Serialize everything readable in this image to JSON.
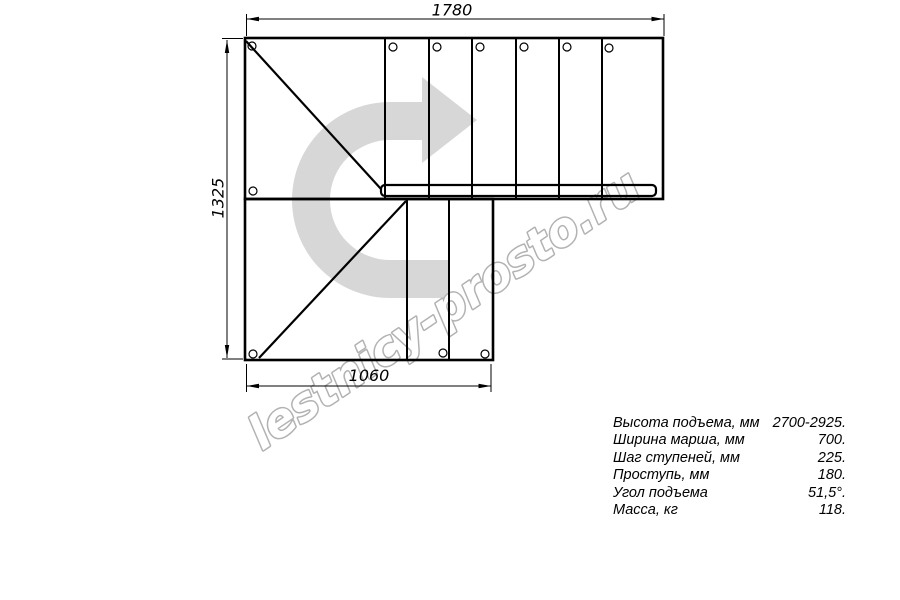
{
  "drawing": {
    "title": "stair-plan-top-view",
    "watermark": "lestnicy-prosto.ru",
    "dimensions": {
      "top": "1780",
      "left": "1325",
      "bottom": "1060"
    },
    "colors": {
      "line": "#000000",
      "arrow_fill": "#d7d7d7",
      "watermark_stroke": "#b2b2b2"
    }
  },
  "specs": {
    "rows": [
      {
        "label": "Высота подъема, мм",
        "value": "2700-2925."
      },
      {
        "label": "Ширина марша, мм",
        "value": "700."
      },
      {
        "label": "Шаг ступеней, мм",
        "value": "225."
      },
      {
        "label": "Проступь, мм",
        "value": "180."
      },
      {
        "label": "Угол подъема",
        "value": "51,5°."
      },
      {
        "label": "Масса, кг",
        "value": "118."
      }
    ]
  }
}
